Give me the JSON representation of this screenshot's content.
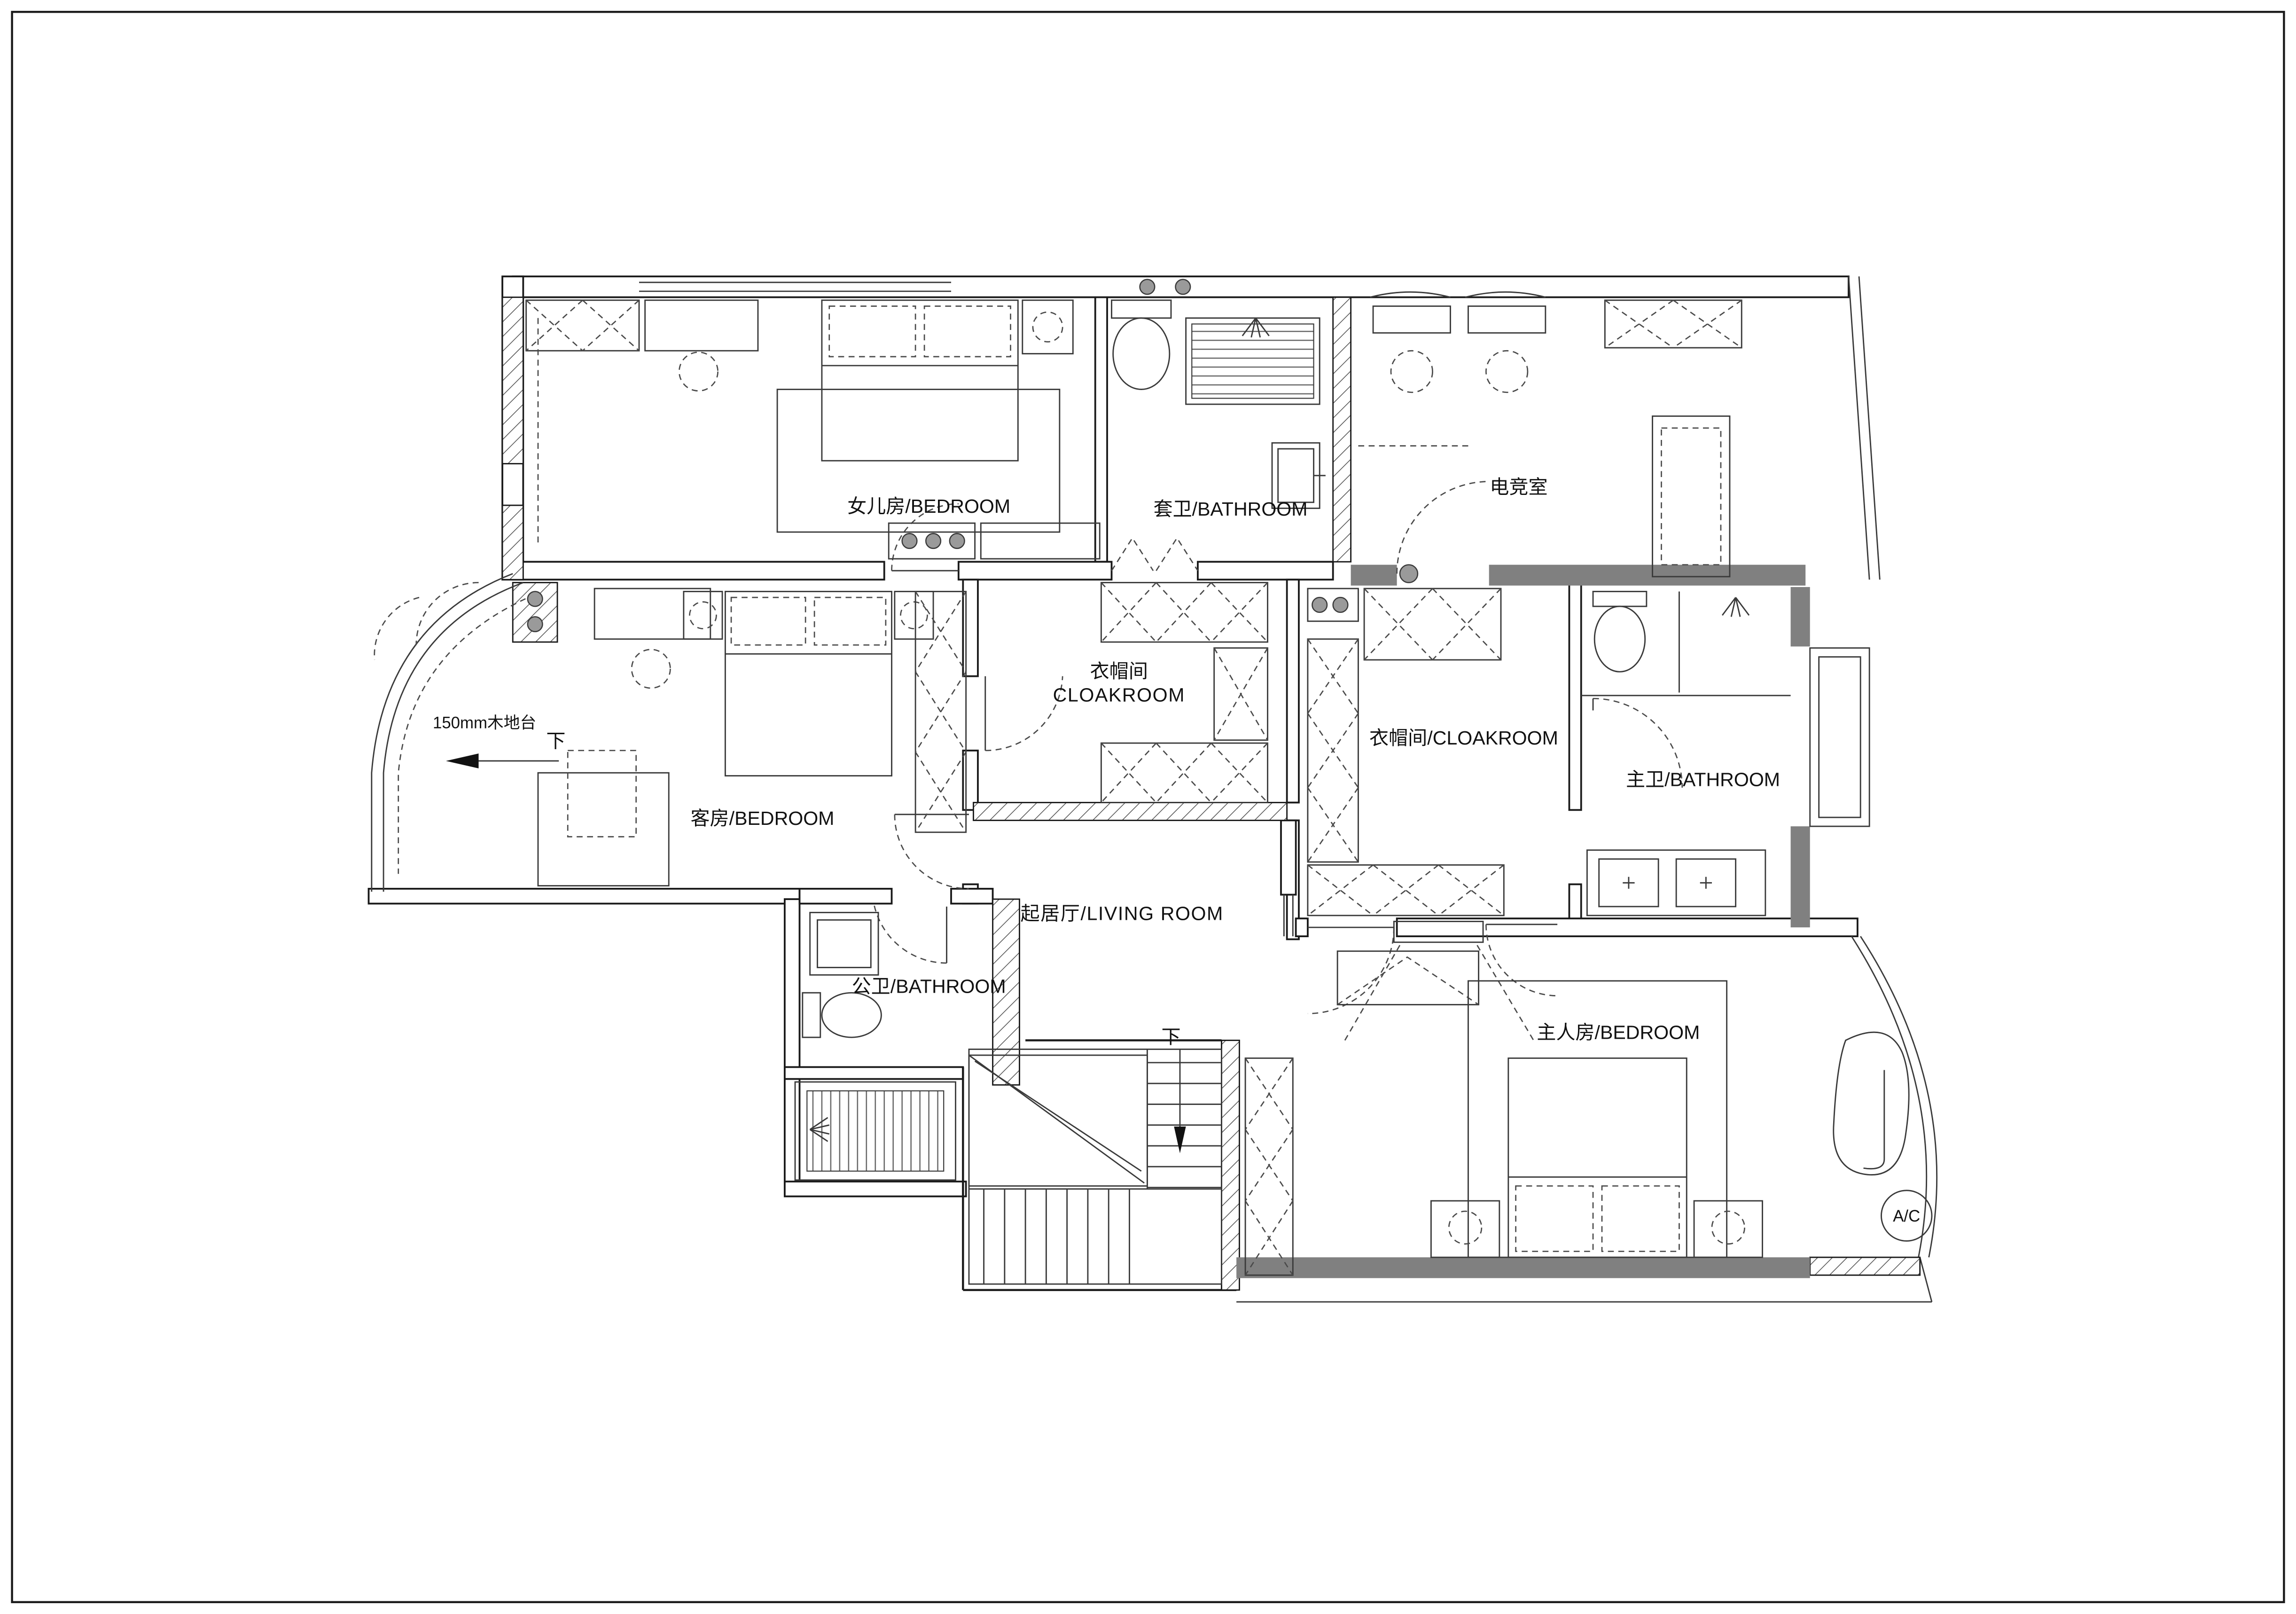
{
  "drawing": {
    "type": "residential-floor-plan",
    "floor_note": "second floor (stairs marked down)",
    "colors": {
      "line": "#1a1a1a",
      "poche_gray": "#808080",
      "background": "#ffffff"
    }
  },
  "rooms": [
    {
      "id": "daughter_bedroom",
      "label": "女儿房/BEDROOM"
    },
    {
      "id": "suite_bathroom",
      "label": "套卫/BATHROOM"
    },
    {
      "id": "esports_room",
      "label": "电竞室"
    },
    {
      "id": "cloakroom_center",
      "label_cn": "衣帽间",
      "label_en": "CLOAKROOM"
    },
    {
      "id": "guest_bedroom",
      "label": "客房/BEDROOM"
    },
    {
      "id": "cloakroom_right",
      "label": "衣帽间/CLOAKROOM"
    },
    {
      "id": "master_bathroom",
      "label": "主卫/BATHROOM"
    },
    {
      "id": "living_room",
      "label": "起居厅/LIVING ROOM"
    },
    {
      "id": "public_bathroom",
      "label": "公卫/BATHROOM"
    },
    {
      "id": "master_bedroom",
      "label": "主人房/BEDROOM"
    }
  ],
  "annotations": {
    "platform_note": "150mm木地台",
    "down_label_guest": "下",
    "down_label_stairs": "下",
    "ac_badge": "A/C"
  }
}
